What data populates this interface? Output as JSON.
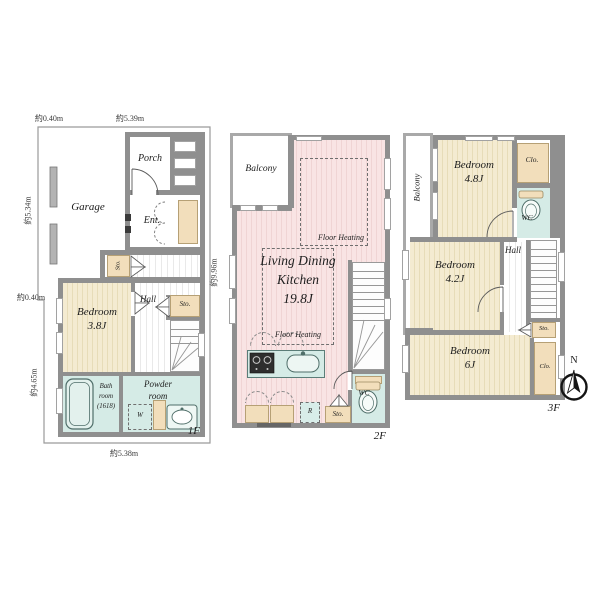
{
  "title": "3-story house floor plan",
  "colors": {
    "wall": "#8f8f8f",
    "bedroom_floor": "#f4ebd1",
    "ldk_floor": "#f9e4e4",
    "wet_area": "#d5ebe6",
    "closet": "#f2debb",
    "balcony_rail": "#a9a9a9"
  },
  "f1": {
    "floor_label": "1F",
    "dim_top_offset": "約0.40m",
    "dim_top_width": "約5.39m",
    "dim_left_upper": "約5.34m",
    "dim_left_offset": "約0.40m",
    "dim_left_lower": "約4.65m",
    "dim_bottom": "約5.38m",
    "garage": "Garage",
    "porch": "Porch",
    "entrance": "Ent.",
    "sto_entry": "Sto.",
    "hall": "Hall",
    "sto_hall": "Sto.",
    "bedroom": "Bedroom\n3.8J",
    "bath": "Bath\nroom\n(1618)",
    "powder": "Powder\nroom",
    "washer": "W"
  },
  "f2": {
    "floor_label": "2F",
    "dim_right": "約9.96m",
    "balcony": "Balcony",
    "ldk": "Living Dining\nKitchen\n19.8J",
    "floor_heating_a": "Floor Heating",
    "floor_heating_b": "Floor Heating",
    "sto": "Sto.",
    "wc": "WC",
    "fridge": "R"
  },
  "f3": {
    "floor_label": "3F",
    "balcony": "Balcony",
    "bedroom_a": "Bedroom\n4.8J",
    "clo_a": "Clo.",
    "wc": "WC",
    "hall": "Hall",
    "bedroom_b": "Bedroom\n4.2J",
    "sto": "Sto.",
    "bedroom_c": "Bedroom\n6J",
    "clo_b": "Clo."
  },
  "compass": {
    "north": "N"
  }
}
